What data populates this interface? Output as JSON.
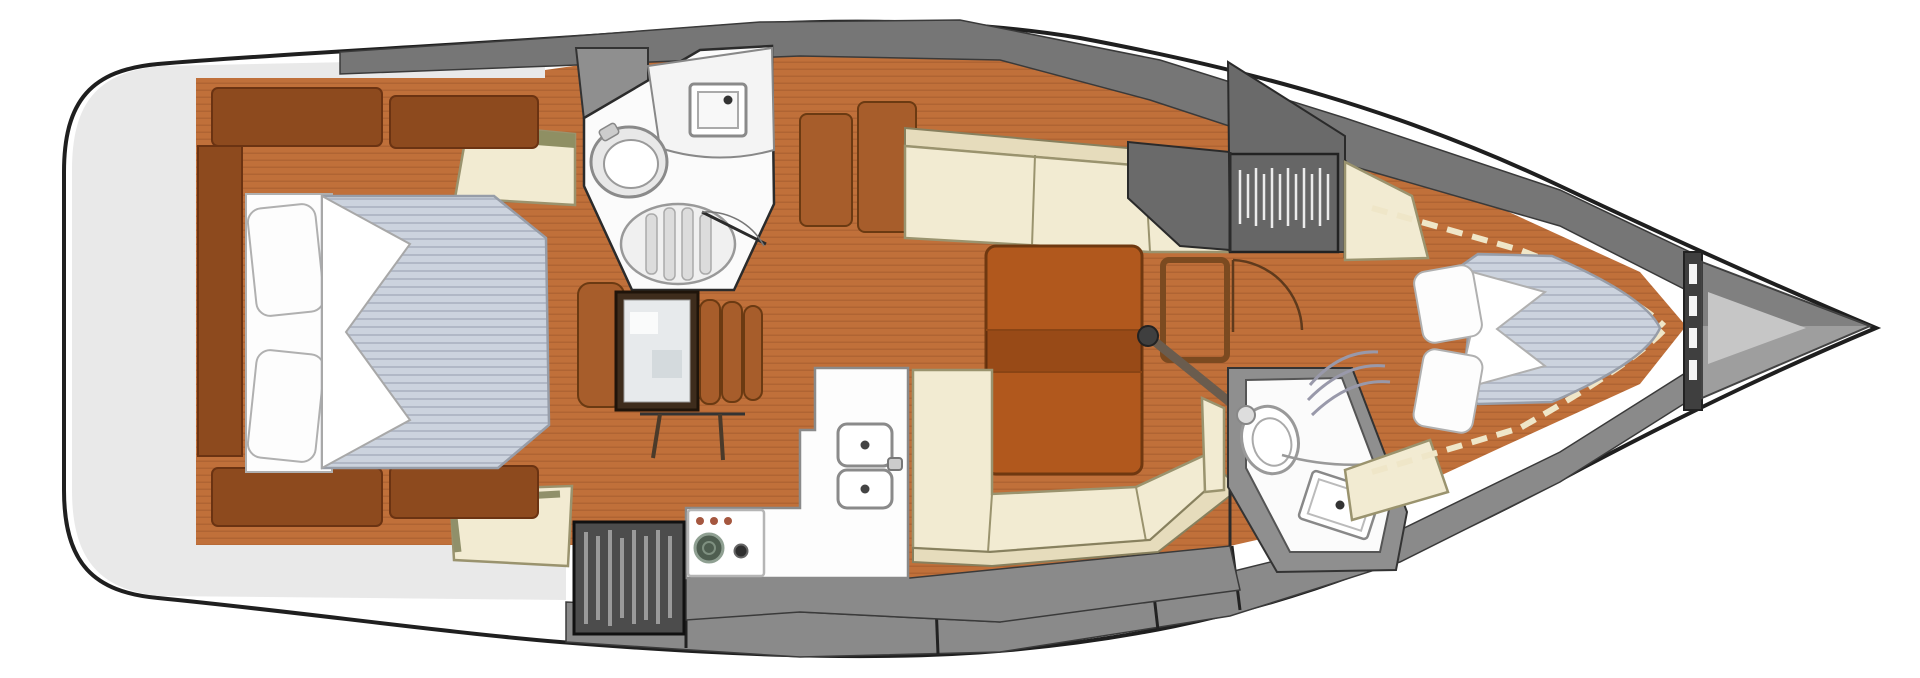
{
  "figure": {
    "kind": "yacht-interior-deck-plan",
    "orientation": {
      "bow": "right",
      "stern": "left"
    }
  },
  "colors": {
    "hull-outline": "#1f1f1f",
    "hull-fill": "#ffffff",
    "stern-platform": "#e9e9e9",
    "deck-top": "#767676",
    "deck-bottom": "#8a8a8a",
    "wall-gray": "#8f8f8f",
    "locker-gray": "#6a6a6a",
    "wood": "#c0703a",
    "wood-panel": "#8d4a1e",
    "wood-mid": "#a75d2b",
    "table": "#b1581d",
    "table-edge": "#6f3810",
    "cream": "#f2ebd2",
    "cream-back": "#e6dcbc",
    "cream-edge": "#9a936e",
    "olive": "#8f8f63",
    "mattress": "#ccd3de",
    "mattress-edge": "#979da8",
    "white": "#fdfdfd",
    "fixture": "#8a8a8a",
    "grate": "#4c4c4c",
    "grate-stripe": "#9a9a9a",
    "chart": "#e7eaec",
    "desk": "#3e2c1c",
    "burner": "#4e5e50",
    "knob": "#a5573f",
    "dash": "#efe6c8",
    "bulkhead": "#3f3f3f",
    "bow-outer": "#9e9e9e",
    "bow-inner": "#c6c6c6"
  },
  "areas": [
    {
      "id": "stern-platform",
      "name": "transom and swim platform"
    },
    {
      "id": "aft-cabin",
      "name": "aft double cabin"
    },
    {
      "id": "aft-head",
      "name": "aft head with shower"
    },
    {
      "id": "nav-station",
      "name": "chart table and seat"
    },
    {
      "id": "galley",
      "name": "L-shaped galley"
    },
    {
      "id": "companionway",
      "name": "companionway steps grate"
    },
    {
      "id": "saloon",
      "name": "saloon with settees and table"
    },
    {
      "id": "wardrobe",
      "name": "hanging locker"
    },
    {
      "id": "forward-head",
      "name": "forward head"
    },
    {
      "id": "forward-cabin",
      "name": "V-berth forward cabin"
    },
    {
      "id": "anchor-locker",
      "name": "bow anchor locker"
    }
  ],
  "fixtures": [
    "double-berth-aft",
    "v-berth-forward",
    "pillows",
    "toilet",
    "washbasin",
    "shower-grate",
    "chart-table",
    "nav-seat",
    "double-sink",
    "two-burner-stove",
    "saloon-table",
    "mast-frame",
    "grab-rail",
    "hanger-stripes",
    "anchor-locker"
  ]
}
